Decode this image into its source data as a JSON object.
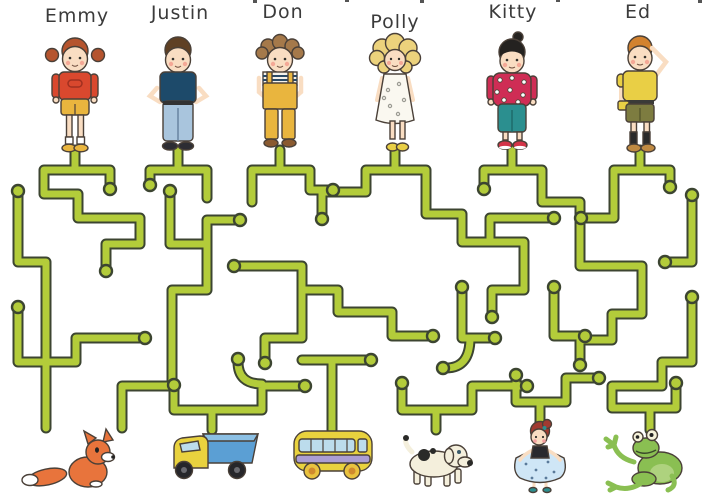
{
  "children": [
    {
      "name": "Emmy"
    },
    {
      "name": "Justin"
    },
    {
      "name": "Don"
    },
    {
      "name": "Polly"
    },
    {
      "name": "Kitty"
    },
    {
      "name": "Ed"
    }
  ],
  "toys": [
    {
      "icon": "fox-figure"
    },
    {
      "icon": "toy-truck"
    },
    {
      "icon": "toy-bus"
    },
    {
      "icon": "toy-dog"
    },
    {
      "icon": "ballerina-doll"
    },
    {
      "icon": "toy-frog"
    }
  ],
  "colors": {
    "maze_path": "#b3cc3a",
    "maze_outline": "#3c4531",
    "ink_outline": "#4a4038",
    "label_ink": "#3b3b3b",
    "skin": "#f9ddc2",
    "emmy_shirt": "#d9482e",
    "mustard": "#e9b53e",
    "justin_shirt": "#1d4a6a",
    "jeans": "#a9c5dd",
    "kitty_sweater": "#cf2d55",
    "teal": "#2b8f8f",
    "ed_shirt": "#e9cf45",
    "olive": "#7d7c40",
    "fox_orange": "#e8743c",
    "truck_blue": "#5b9fd4",
    "bus_purple": "#ab9dd3",
    "frog_green": "#8abf52"
  }
}
